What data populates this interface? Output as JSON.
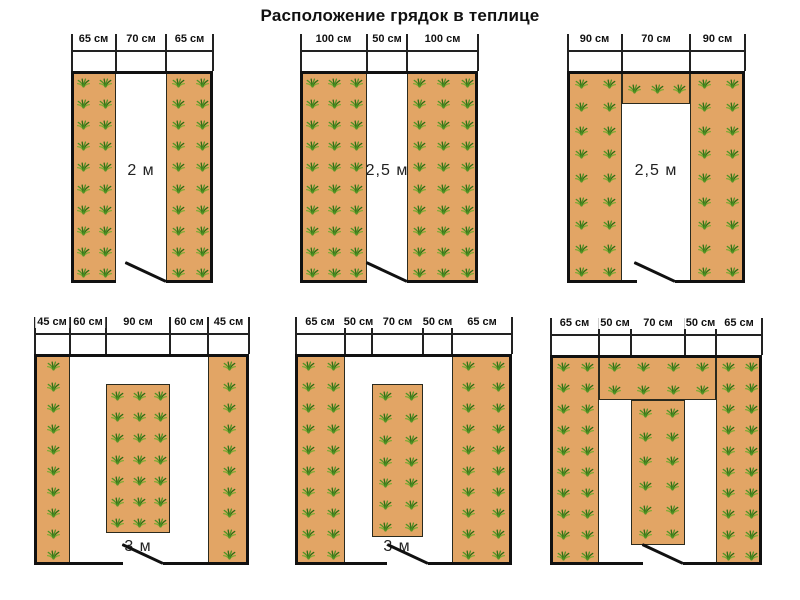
{
  "title": "Расположение грядок в теплице",
  "colors": {
    "bed": "#e2a565",
    "wall": "#111111",
    "dimension_line": "#222222",
    "plant_dark": "#2f6b14",
    "plant_mid": "#4f9426",
    "plant_light": "#7bab33"
  },
  "diagrams": [
    {
      "name": "two-side-beds-2m",
      "box": {
        "x": 71,
        "y": 71,
        "w": 142,
        "h": 212
      },
      "dims": [
        {
          "label": "65 см"
        },
        {
          "label": "70 см"
        },
        {
          "label": "65 см"
        }
      ],
      "boundaries": [
        0,
        45,
        95,
        142
      ],
      "beds": [
        {
          "x": 0,
          "y": 0,
          "w": 45,
          "h": 212,
          "cols": 2,
          "rows": 10
        },
        {
          "x": 95,
          "y": 0,
          "w": 47,
          "h": 212,
          "cols": 2,
          "rows": 10
        }
      ],
      "center_label": {
        "text": "2 м",
        "cx": 70,
        "cy": 100
      },
      "door": {
        "x": 45,
        "w": 50
      }
    },
    {
      "name": "two-side-beds-2-5m",
      "box": {
        "x": 300,
        "y": 71,
        "w": 178,
        "h": 212
      },
      "dims": [
        {
          "label": "100 см"
        },
        {
          "label": "50 см"
        },
        {
          "label": "100 см"
        }
      ],
      "boundaries": [
        0,
        67,
        107,
        178
      ],
      "beds": [
        {
          "x": 0,
          "y": 0,
          "w": 67,
          "h": 212,
          "cols": 3,
          "rows": 10
        },
        {
          "x": 107,
          "y": 0,
          "w": 71,
          "h": 212,
          "cols": 3,
          "rows": 10
        }
      ],
      "center_label": {
        "text": "2,5 м",
        "cx": 87,
        "cy": 100
      },
      "door": {
        "x": 67,
        "w": 40
      }
    },
    {
      "name": "u-shape-beds-2-5m",
      "box": {
        "x": 567,
        "y": 71,
        "w": 178,
        "h": 212
      },
      "dims": [
        {
          "label": "90 см"
        },
        {
          "label": "70 см"
        },
        {
          "label": "90 см"
        }
      ],
      "boundaries": [
        0,
        55,
        123,
        178
      ],
      "beds": [
        {
          "x": 0,
          "y": 0,
          "w": 55,
          "h": 212,
          "cols": 2,
          "rows": 9
        },
        {
          "x": 55,
          "y": 0,
          "w": 68,
          "h": 33,
          "cols": 3,
          "rows": 1
        },
        {
          "x": 123,
          "y": 0,
          "w": 55,
          "h": 212,
          "cols": 2,
          "rows": 9
        }
      ],
      "center_label": {
        "text": "2,5 м",
        "cx": 89,
        "cy": 100
      },
      "door": {
        "x": 70,
        "w": 38
      }
    },
    {
      "name": "three-beds-3m-narrow-sides",
      "box": {
        "x": 34,
        "y": 354,
        "w": 215,
        "h": 211
      },
      "dims": [
        {
          "label": "45 см"
        },
        {
          "label": "60 см"
        },
        {
          "label": "90 см"
        },
        {
          "label": "60 см"
        },
        {
          "label": "45 см"
        }
      ],
      "boundaries": [
        0,
        36,
        72,
        136,
        174,
        215
      ],
      "beds": [
        {
          "x": 0,
          "y": 0,
          "w": 36,
          "h": 211,
          "cols": 1,
          "rows": 10
        },
        {
          "x": 72,
          "y": 30,
          "w": 64,
          "h": 149,
          "cols": 3,
          "rows": 7
        },
        {
          "x": 174,
          "y": 0,
          "w": 41,
          "h": 211,
          "cols": 1,
          "rows": 10
        }
      ],
      "center_label": {
        "text": "3 м",
        "cx": 104,
        "cy": 193
      },
      "door": {
        "x": 89,
        "w": 40
      }
    },
    {
      "name": "three-beds-3m-wide-sides",
      "box": {
        "x": 295,
        "y": 354,
        "w": 217,
        "h": 211
      },
      "dims": [
        {
          "label": "65 см"
        },
        {
          "label": "50 см"
        },
        {
          "label": "70 см"
        },
        {
          "label": "50 см"
        },
        {
          "label": "65 см"
        }
      ],
      "boundaries": [
        0,
        50,
        77,
        128,
        157,
        217
      ],
      "beds": [
        {
          "x": 0,
          "y": 0,
          "w": 50,
          "h": 211,
          "cols": 2,
          "rows": 10
        },
        {
          "x": 77,
          "y": 30,
          "w": 51,
          "h": 153,
          "cols": 2,
          "rows": 7
        },
        {
          "x": 157,
          "y": 0,
          "w": 60,
          "h": 211,
          "cols": 2,
          "rows": 10
        }
      ],
      "center_label": {
        "text": "3 м",
        "cx": 102,
        "cy": 193
      },
      "door": {
        "x": 92,
        "w": 41
      }
    },
    {
      "name": "comb-shape-beds",
      "box": {
        "x": 550,
        "y": 355,
        "w": 212,
        "h": 210
      },
      "dims": [
        {
          "label": "65 см"
        },
        {
          "label": "50 см"
        },
        {
          "label": "70 см"
        },
        {
          "label": "50 см"
        },
        {
          "label": "65 см"
        }
      ],
      "boundaries": [
        0,
        49,
        81,
        135,
        166,
        212
      ],
      "beds": [
        {
          "x": 0,
          "y": 0,
          "w": 49,
          "h": 210,
          "cols": 2,
          "rows": 10
        },
        {
          "x": 49,
          "y": 0,
          "w": 117,
          "h": 45,
          "cols": 4,
          "rows": 2
        },
        {
          "x": 81,
          "y": 45,
          "w": 54,
          "h": 145,
          "cols": 2,
          "rows": 6
        },
        {
          "x": 166,
          "y": 0,
          "w": 46,
          "h": 210,
          "cols": 2,
          "rows": 10
        }
      ],
      "center_label": null,
      "door": {
        "x": 93,
        "w": 40
      }
    }
  ]
}
